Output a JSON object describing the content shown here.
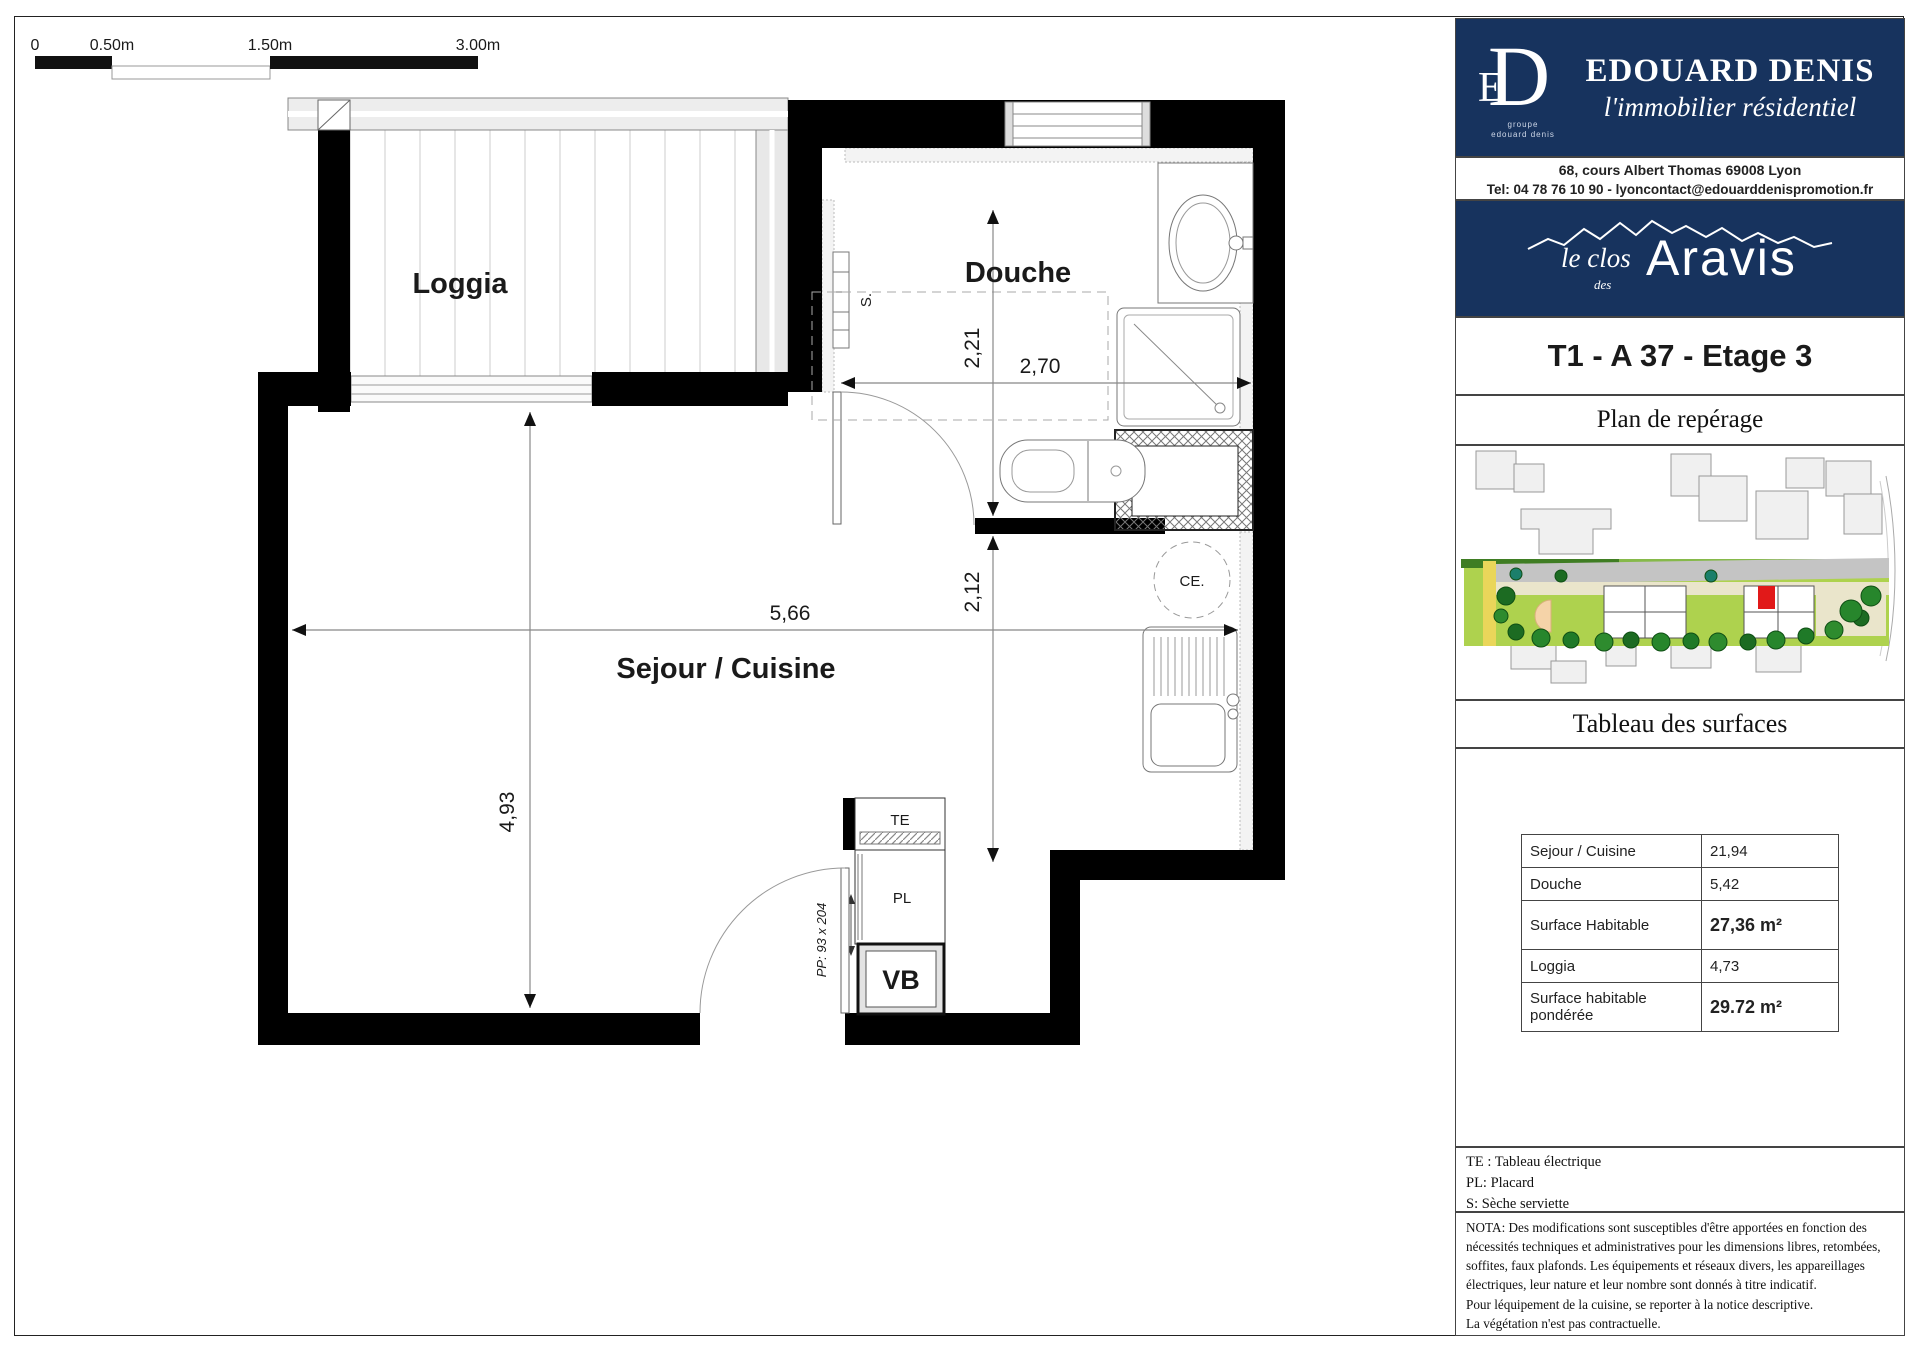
{
  "scale_bar": {
    "labels": [
      "0",
      "0.50m",
      "1.50m",
      "3.00m"
    ]
  },
  "plan": {
    "room_labels": {
      "loggia": "Loggia",
      "douche": "Douche",
      "sejour": "Sejour / Cuisine"
    },
    "annotations": {
      "towel_dryer": "S.",
      "water_heater": "CE.",
      "electrical_panel": "TE",
      "closet": "PL",
      "vb": "VB",
      "entry_door": "PP: 93 x 204"
    },
    "dimensions": {
      "bath_depth": "2,21",
      "bath_width": "2,70",
      "living_width": "5,66",
      "mid_depth": "2,12",
      "living_depth": "4,93"
    }
  },
  "sidebar": {
    "brand": {
      "group_line1": "groupe",
      "group_line2": "edouard denis",
      "name": "EDOUARD DENIS",
      "tagline": "l'immobilier résidentiel",
      "address": "68, cours Albert Thomas 69008 Lyon",
      "contact": "Tel: 04 78 76 10 90 - lyoncontact@edouarddenispromotion.fr"
    },
    "project": {
      "prefix": "le clos",
      "des": "des",
      "name": "Aravis"
    },
    "unit_title": "T1 - A 37 - Etage 3",
    "map_title": "Plan de repérage",
    "surfaces_title": "Tableau des surfaces",
    "table": {
      "rows": [
        {
          "label": "Sejour / Cuisine",
          "value": "21,94"
        },
        {
          "label": "Douche",
          "value": "5,42"
        },
        {
          "label": "Surface Habitable",
          "value": "27,36 m²"
        },
        {
          "label": "Loggia",
          "value": "4,73"
        },
        {
          "label": "Surface habitable pondérée",
          "value": "29.72 m²"
        }
      ]
    },
    "legend": [
      "TE : Tableau électrique",
      "PL: Placard",
      "S: Sèche serviette"
    ],
    "nota": [
      "NOTA: Des modifications sont susceptibles d'être apportées en fonction des",
      "nécessités techniques et administratives pour les dimensions libres, retombées,",
      "soffites, faux plafonds. Les équipements et réseaux divers, les appareillages",
      "électriques, leur nature et leur nombre sont donnés à titre indicatif.",
      "Pour léquipement de la cuisine, se reporter à la notice descriptive.",
      "La végétation n'est pas contractuelle."
    ]
  },
  "colors": {
    "navy": "#17335e",
    "wall": "#000000",
    "unit_marker": "#e11919",
    "lawn_green": "#aed24e"
  }
}
